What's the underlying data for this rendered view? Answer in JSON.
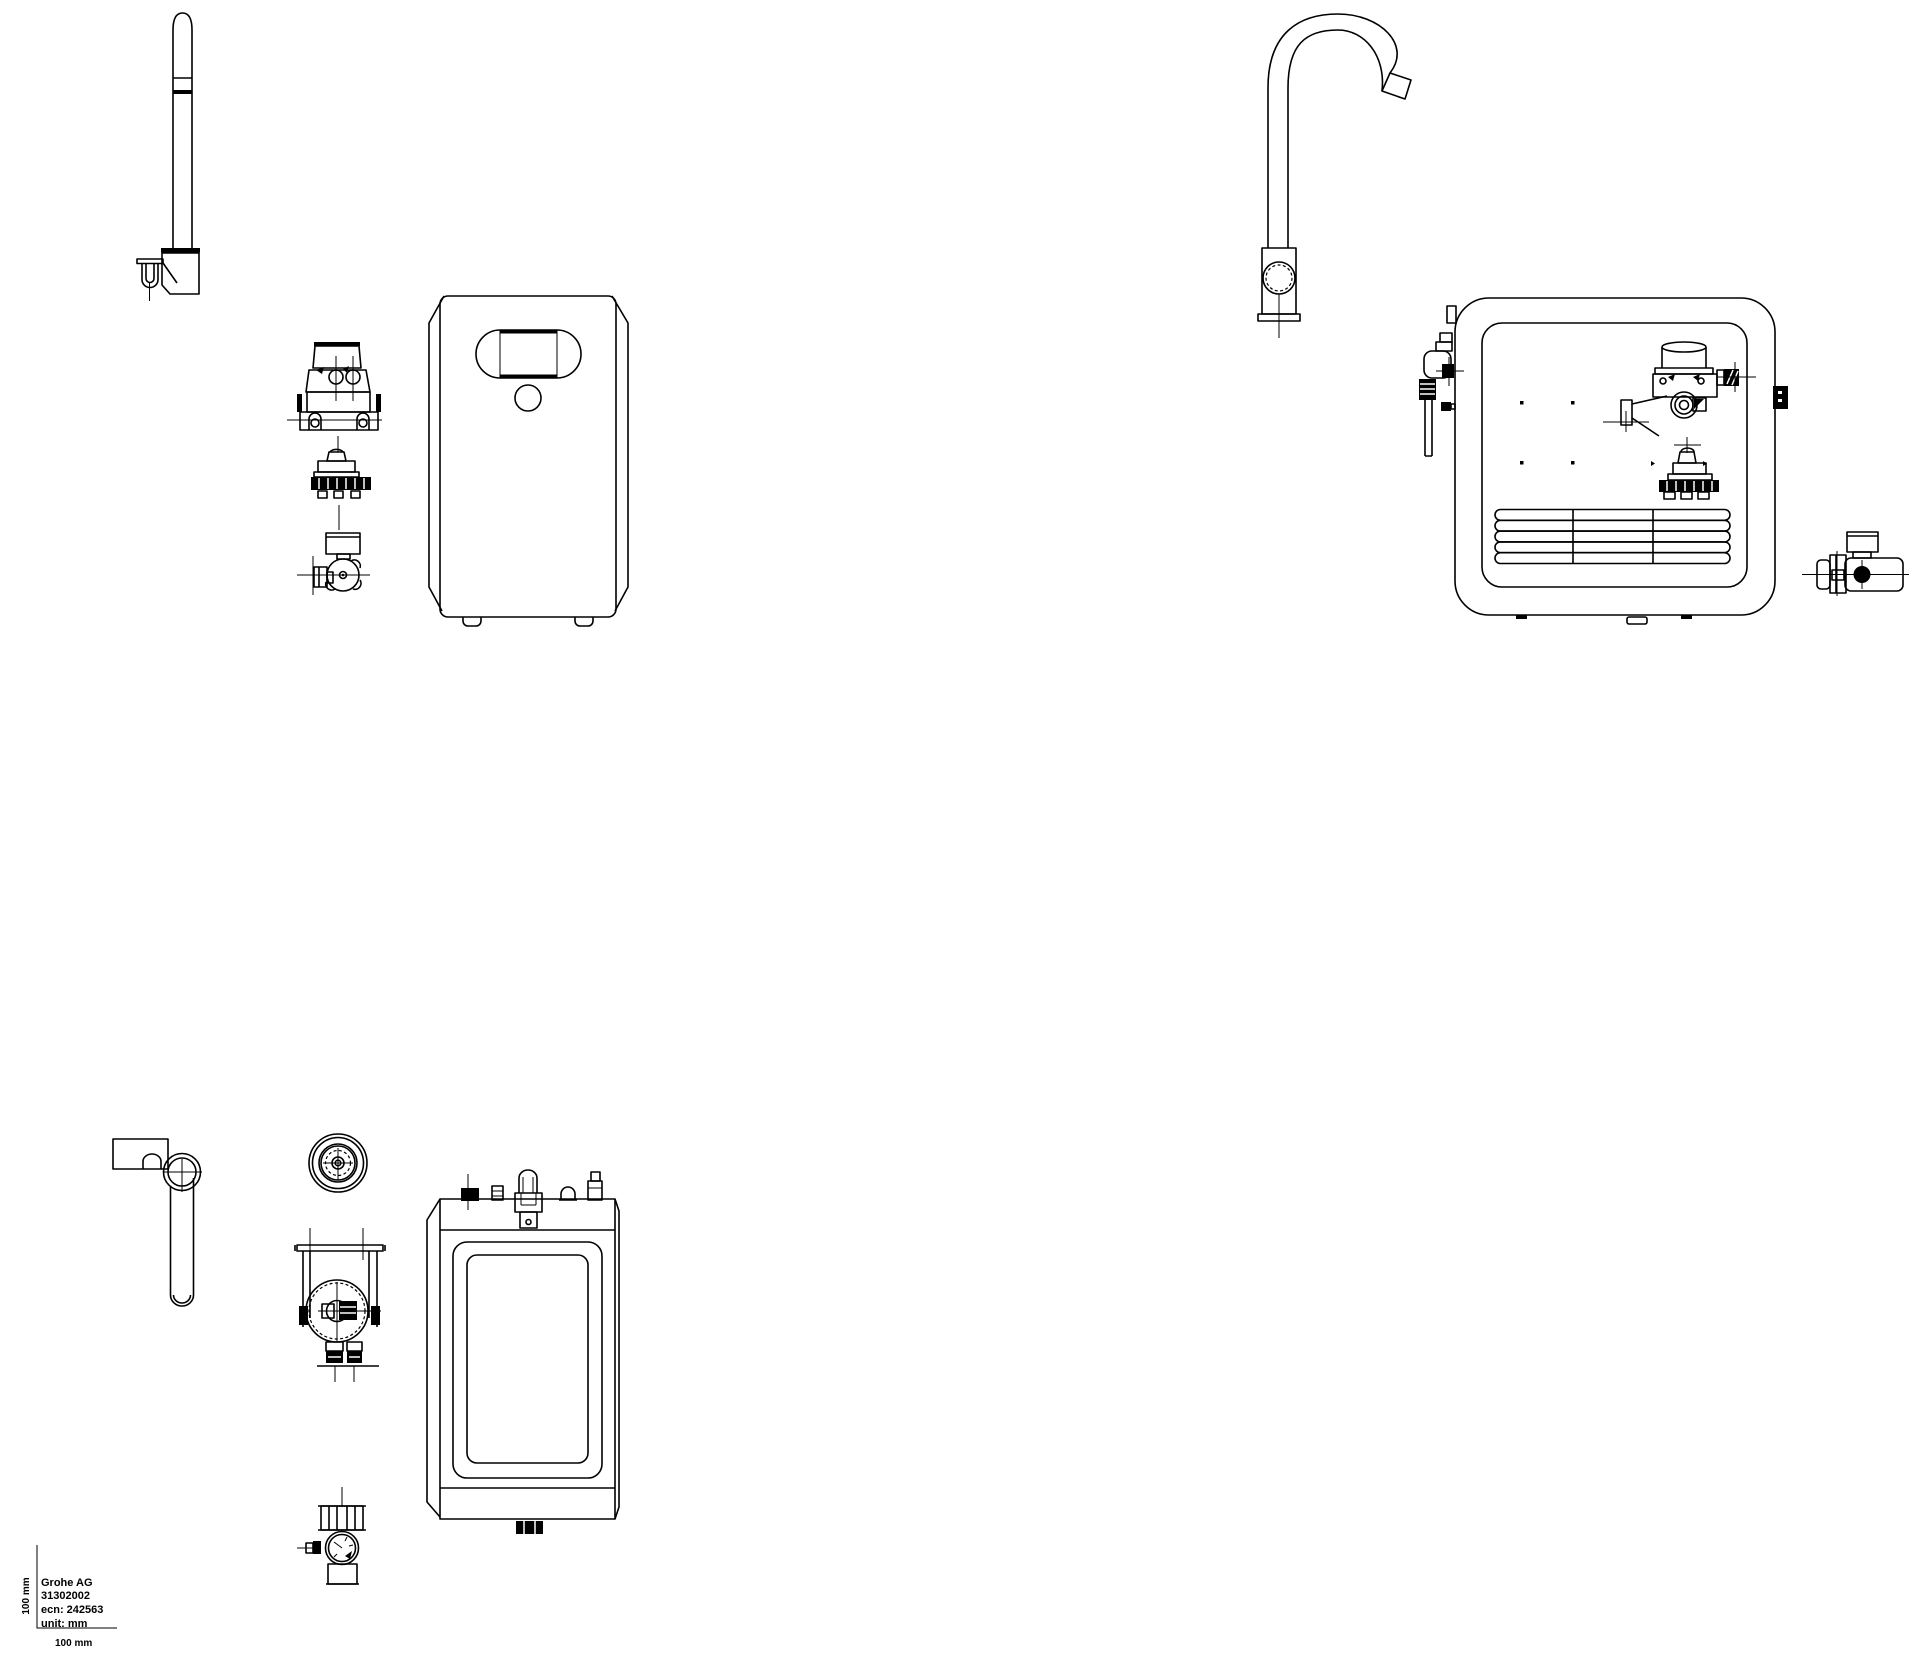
{
  "page": {
    "background_color": "#ffffff",
    "line_color": "#000000"
  },
  "title_block": {
    "manufacturer": "Grohe AG",
    "product_number": "31302002",
    "ecn": "ecn: 242563",
    "unit": "unit: mm",
    "scale_horizontal_label": "100 mm",
    "scale_vertical_label": "100 mm"
  }
}
